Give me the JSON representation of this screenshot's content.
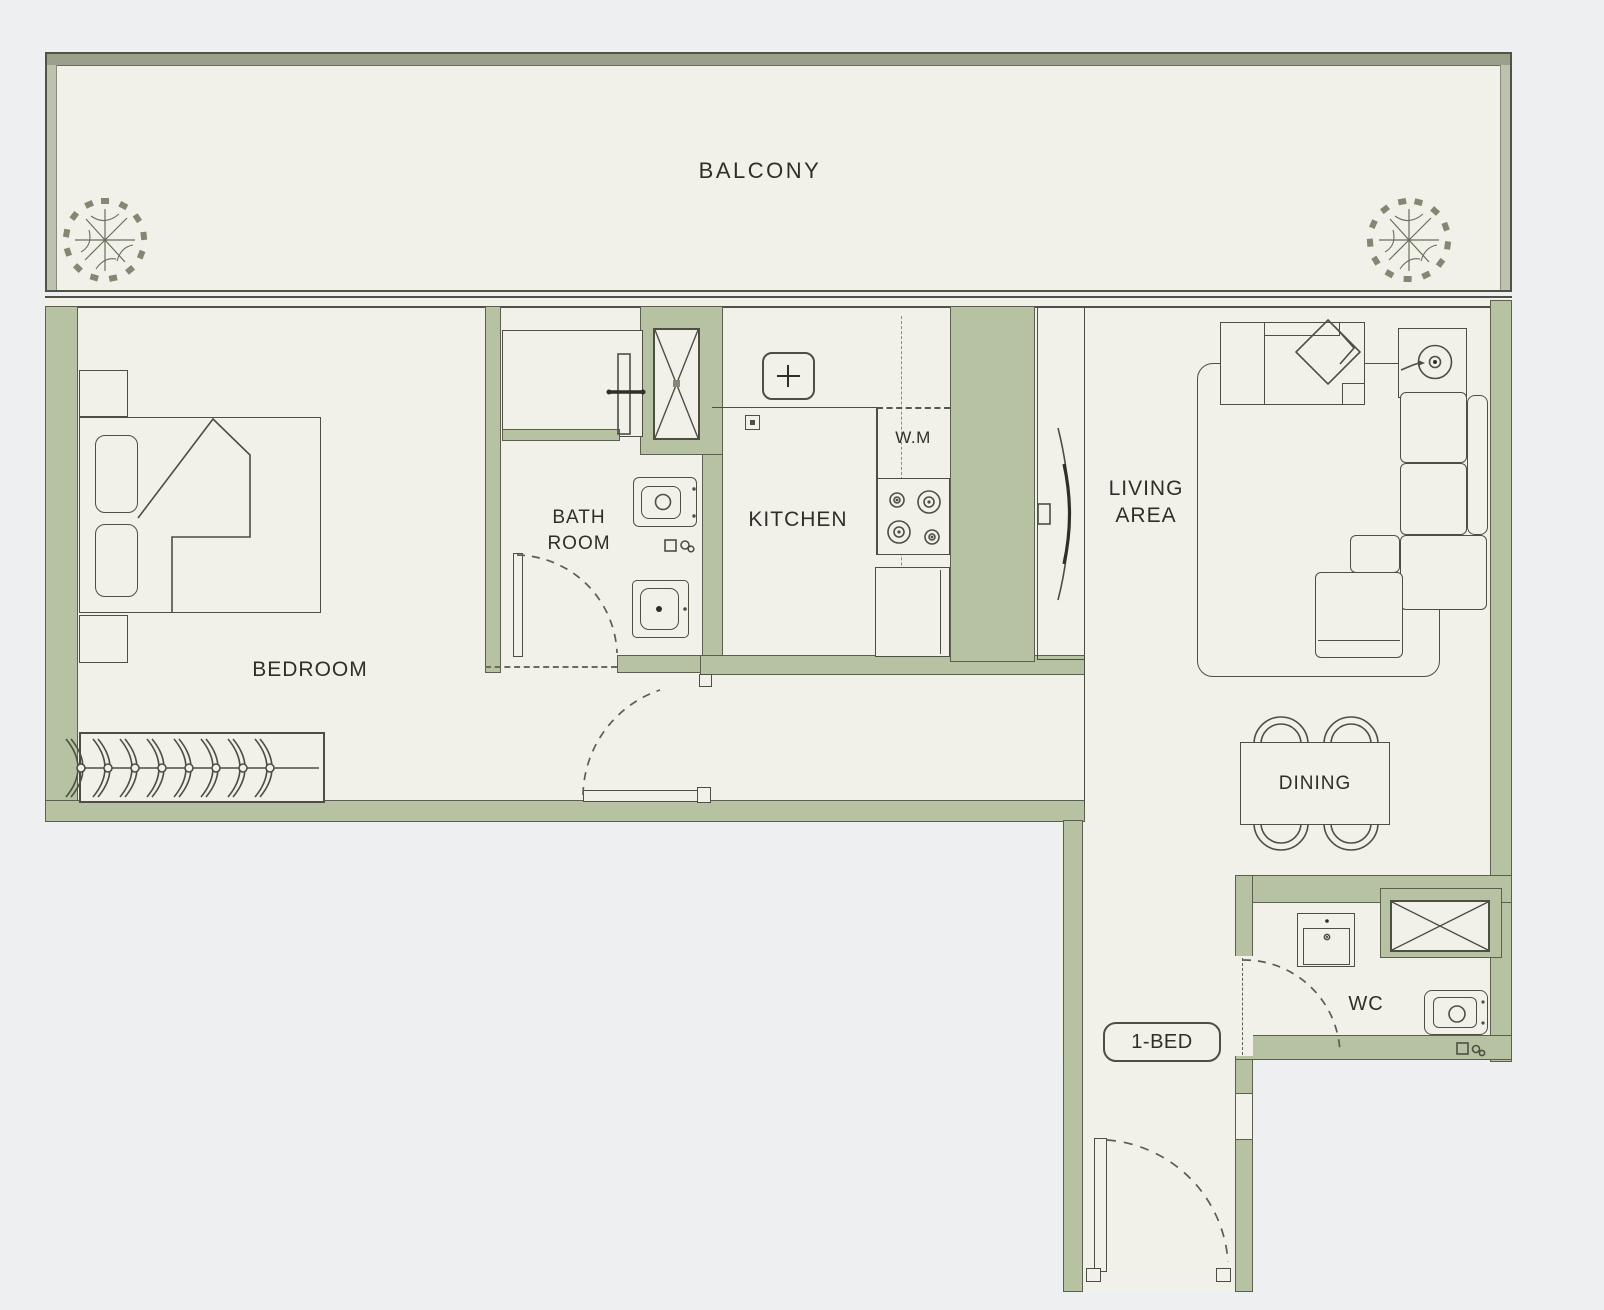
{
  "plan": {
    "unit_type_label": "1-BED",
    "rooms": {
      "balcony": {
        "label": "BALCONY"
      },
      "bedroom": {
        "label": "BEDROOM"
      },
      "bathroom": {
        "line1": "BATH",
        "line2": "ROOM"
      },
      "kitchen": {
        "label": "KITCHEN",
        "washing_machine_label": "W.M"
      },
      "living_area": {
        "line1": "LIVING",
        "line2": "AREA"
      },
      "dining": {
        "label": "DINING"
      },
      "wc": {
        "label": "WC"
      }
    },
    "colors": {
      "wall": "#b6c2a2",
      "floor": "#f1f0e9",
      "outline": "#4d4f43",
      "background": "#edeff0",
      "balcony_slab": "#9aa089"
    },
    "icons": [
      "plant-icon",
      "bed-icon",
      "pillow-icon",
      "hanger-rail-icon",
      "shower-icon",
      "shaft-cross-icon",
      "washbasin-icon",
      "toilet-icon",
      "floor-drain-icon",
      "door-swing-icon",
      "kitchen-sink-icon",
      "stove-burners-icon",
      "fridge-icon",
      "tv-icon",
      "rug-icon",
      "sofa-icon",
      "floor-lamp-icon",
      "dining-table-icon",
      "dining-chair-icon",
      "wc-sink-icon"
    ]
  }
}
